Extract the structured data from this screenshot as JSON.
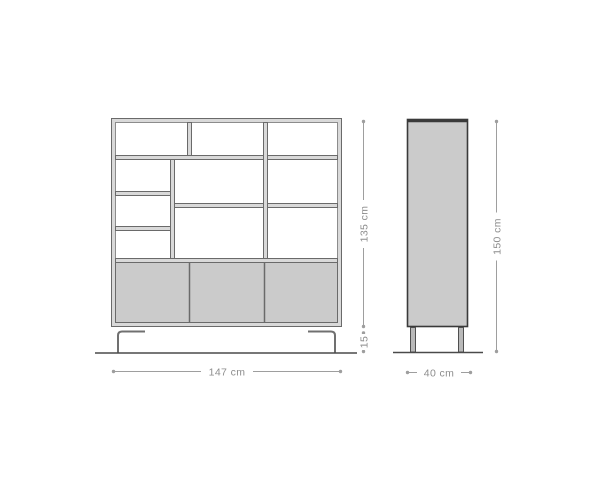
{
  "drawing": {
    "front_view": {
      "width_label": "147 cm",
      "body_height_label": "135 cm",
      "base_height_label": "15"
    },
    "side_view": {
      "depth_label": "40 cm",
      "total_height_label": "150 cm"
    },
    "colors": {
      "outline": "#6a6a6a",
      "outline_light": "#8c8c8c",
      "outline_dark": "#3a3a3a",
      "frame_fill": "#d9d9d9",
      "panel_fill": "#cbcbcb",
      "leg_fill": "#b9b9b9",
      "leg_stroke": "#707070",
      "ground": "#4a4a4a",
      "dimension_line": "#9e9e9e",
      "dimension_text": "#8d8d8d",
      "background": "#ffffff"
    }
  }
}
